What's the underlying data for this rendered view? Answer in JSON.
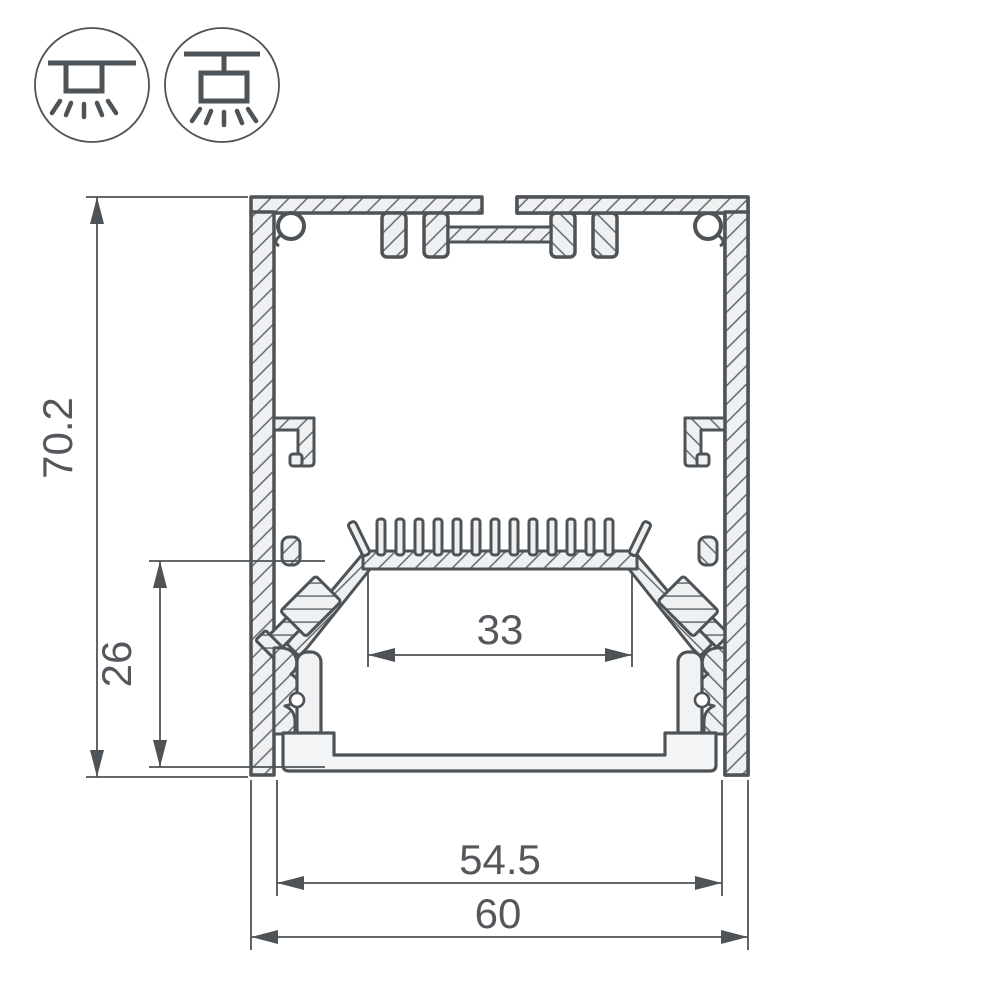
{
  "drawing": {
    "background": "#ffffff",
    "line_color": "#4e5357",
    "aluminum_fill": "#eef0f1",
    "text_color": "#54585c",
    "dimensions": {
      "overall_height": "70.2",
      "inner_height": "26",
      "led_platform_width": "33",
      "inner_width": "54.5",
      "overall_width": "60"
    },
    "icons": [
      {
        "name": "surface-mount-icon"
      },
      {
        "name": "pendant-mount-icon"
      }
    ]
  }
}
